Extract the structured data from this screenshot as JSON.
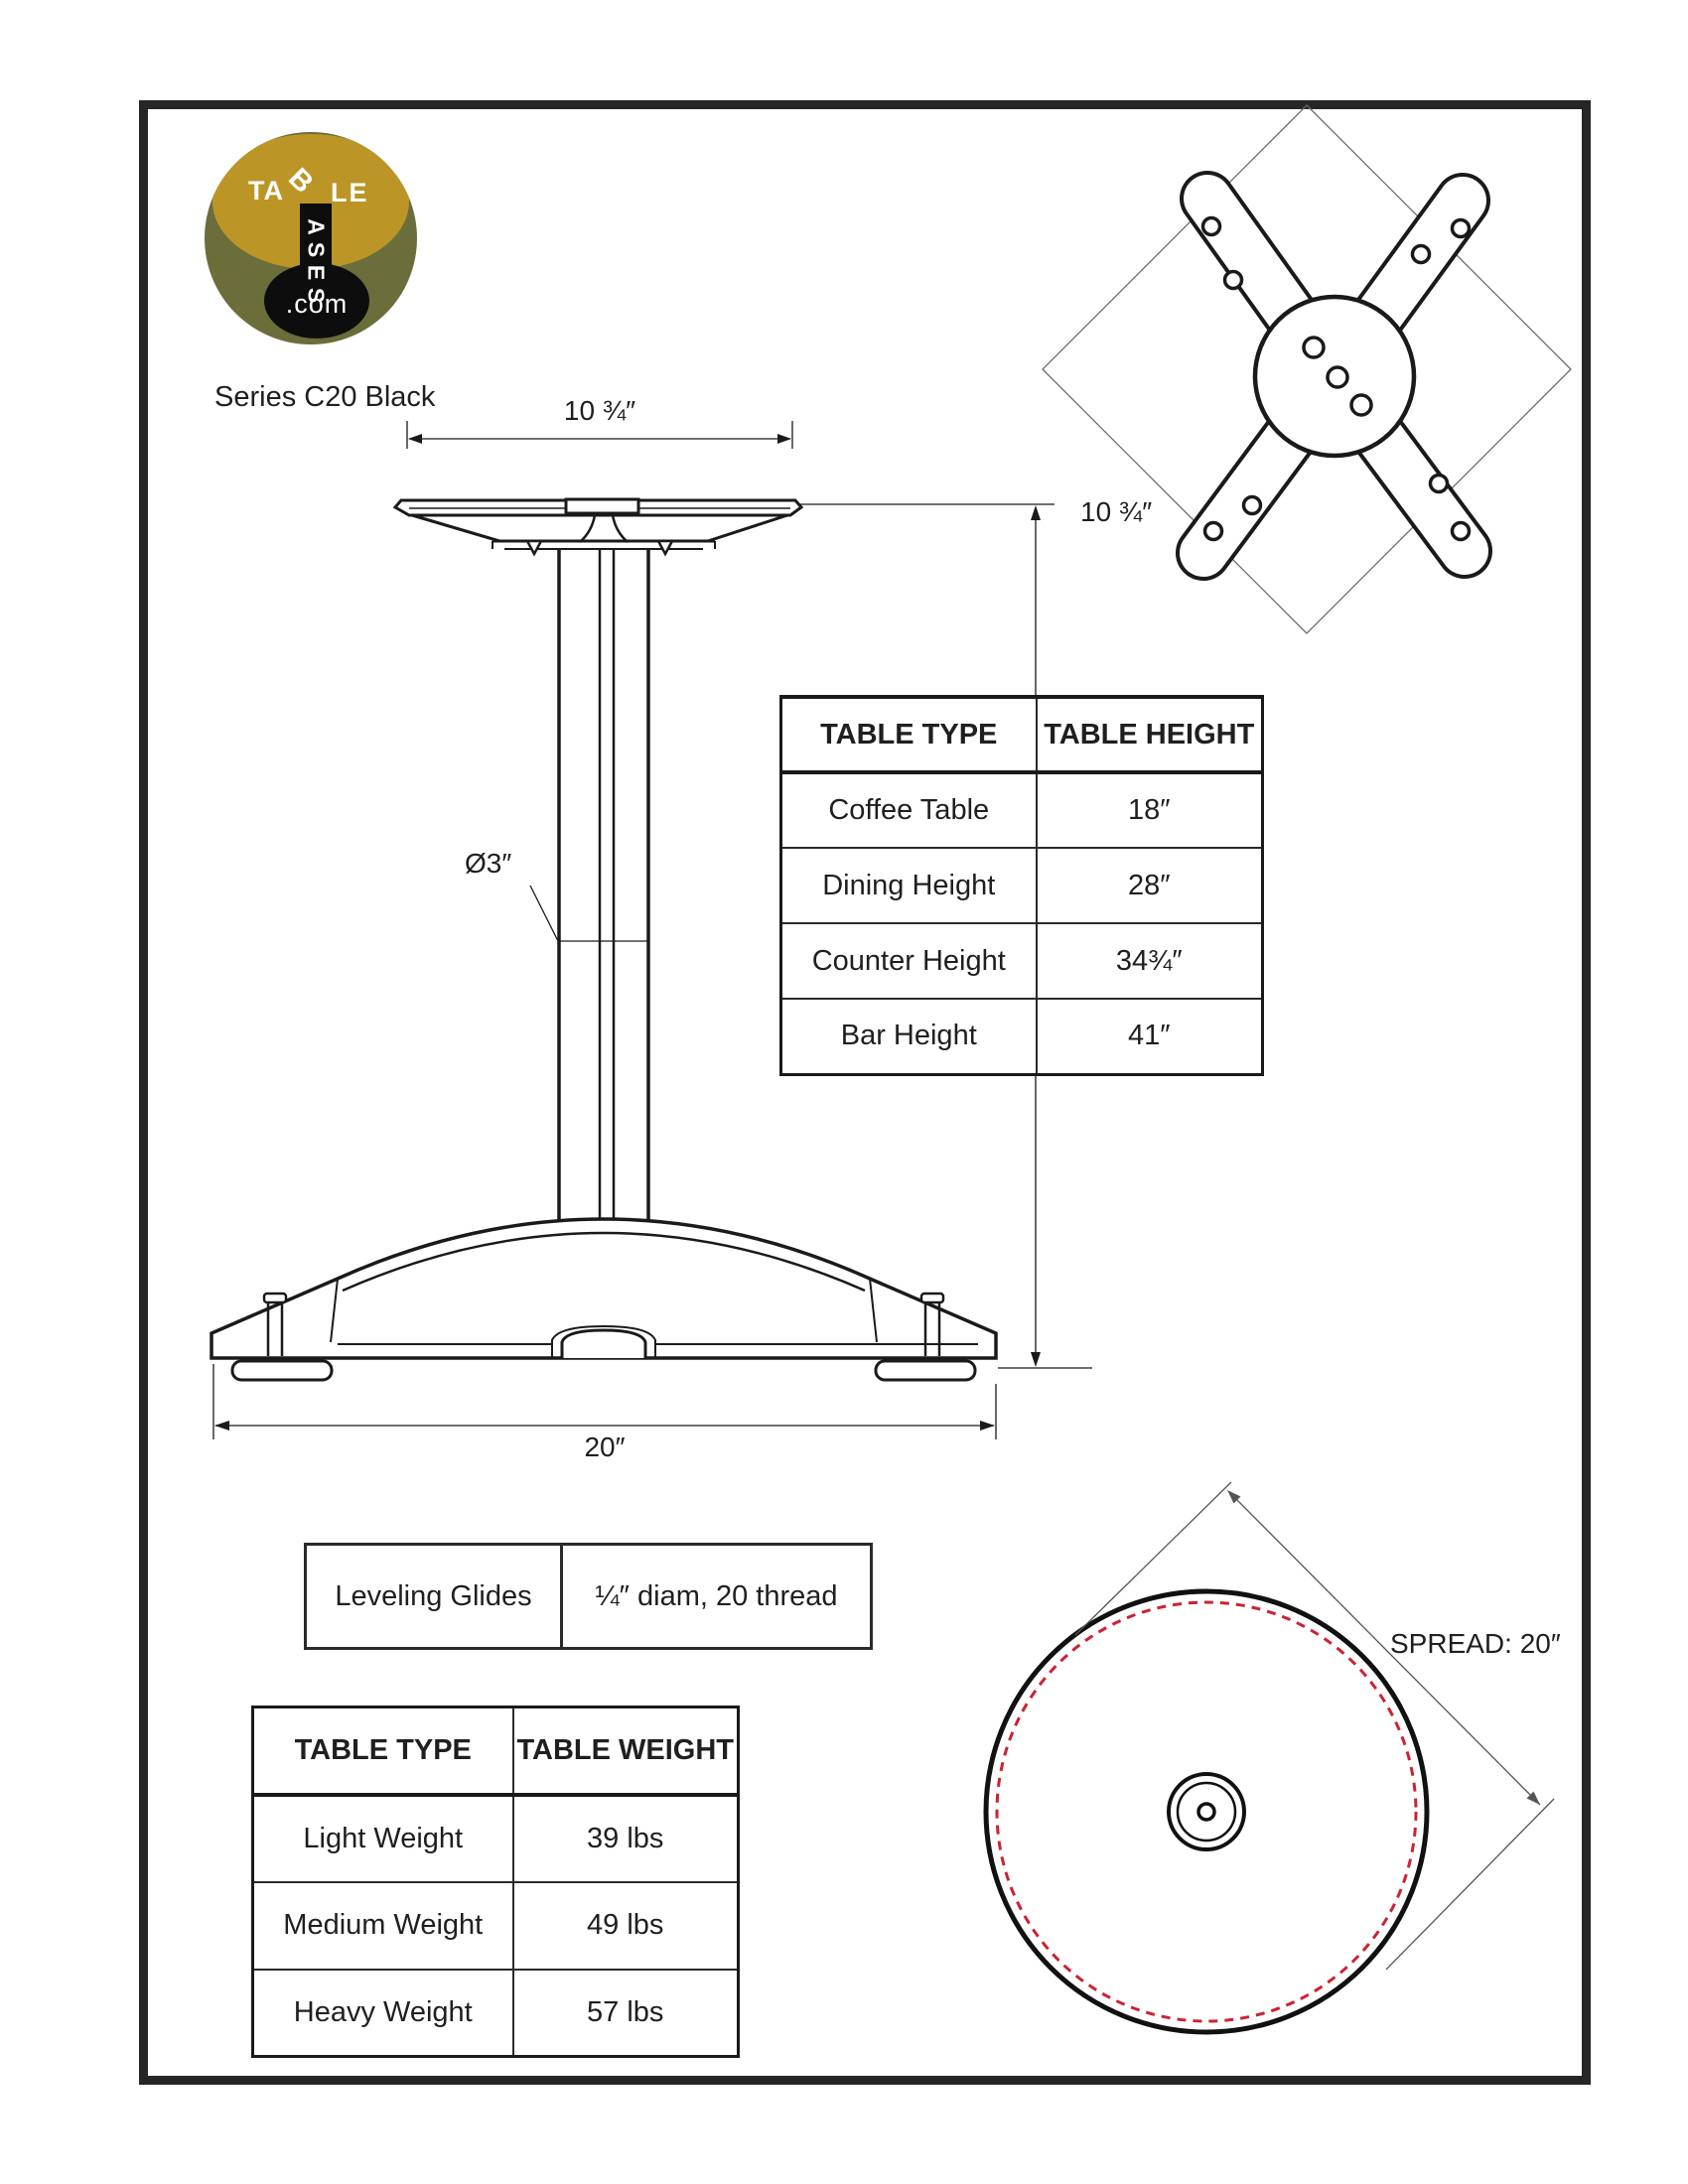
{
  "page": {
    "title": "Series C20 Black"
  },
  "logo": {
    "word_top_start": "TA",
    "shared_letter": "B",
    "word_top_end": "LE",
    "vertical_letters": [
      "A",
      "S",
      "E",
      "S"
    ],
    "domain": ".com",
    "colors": {
      "olive": "#6b6d3a",
      "gold": "#bb9626",
      "black": "#0d0d0d"
    }
  },
  "front_view": {
    "top_width_label": "10 ¾″",
    "column_diameter_label": "Ø3″",
    "base_width_label": "20″"
  },
  "top_view": {
    "width_label": "10 ¾″"
  },
  "height_table": {
    "headers": [
      "TABLE TYPE",
      "TABLE HEIGHT"
    ],
    "rows": [
      [
        "Coffee Table",
        "18″"
      ],
      [
        "Dining Height",
        "28″"
      ],
      [
        "Counter Height",
        "34¾″"
      ],
      [
        "Bar Height",
        "41″"
      ]
    ]
  },
  "glides_table": {
    "label": "Leveling Glides",
    "value": "¼″ diam, 20 thread"
  },
  "weight_table": {
    "headers": [
      "TABLE TYPE",
      "TABLE WEIGHT"
    ],
    "rows": [
      [
        "Light Weight",
        "39 lbs"
      ],
      [
        "Medium Weight",
        "49 lbs"
      ],
      [
        "Heavy Weight",
        "57 lbs"
      ]
    ]
  },
  "spread_view": {
    "label": "SPREAD: 20″",
    "dash_color": "#cc2231"
  }
}
